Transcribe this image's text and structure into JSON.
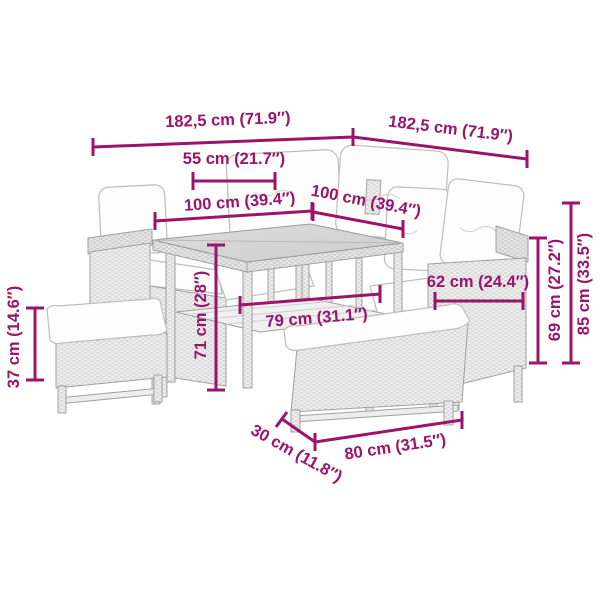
{
  "diagram": {
    "accent_color": "#9b136b",
    "scene": "line drawing of a poly rattan garden lounge set: corner sofa with cushions, square glass-top dining table, small side bench and front bench",
    "dims": {
      "total_left": "182,5 cm (71.9″)",
      "total_right": "182,5 cm (71.9″)",
      "stool_top": "55 cm (21.7″)",
      "table_side_left": "100 cm (39.4″)",
      "table_side_right": "100 cm (39.4″)",
      "table_height": "71 cm (28″)",
      "table_clearance": "79 cm (31.1″)",
      "sofa_seat_depth": "62 cm (24.4″)",
      "armrest_height": "69 cm (27.2″)",
      "back_height": "85 cm (33.5″)",
      "stool_height": "37 cm (14.6″)",
      "bench_depth": "30 cm (11.8″)",
      "bench_width": "80 cm (31.5″)"
    }
  }
}
